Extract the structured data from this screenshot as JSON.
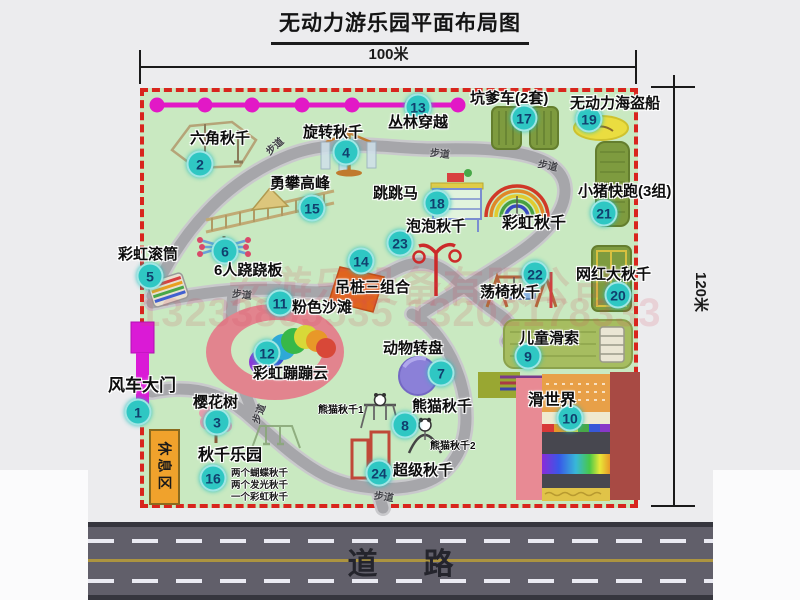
{
  "title": "无动力游乐园平面布局图",
  "dim_top": "100米",
  "dim_right": "120米",
  "road": {
    "label": "道路"
  },
  "rest_area": "休息区",
  "walkway_text": "步道",
  "watermark": {
    "line1": "安游乐设备有限公司",
    "line2": "13233805535 13202178333"
  },
  "colors": {
    "badge_fill": "#2fc7c3",
    "badge_text": "#10406e",
    "border_red": "#d8251d",
    "park_green": "#c9e9c1",
    "path_gray": "#a6a6aa",
    "zipline_magenta": "#e218c6",
    "gate_magenta": "#da1ad6",
    "rest_orange": "#f0a22c",
    "road_gray": "#615f6a",
    "watermark_pink": "rgba(214,72,92,0.38)"
  },
  "attractions": [
    {
      "id": 1,
      "name": "风车大门",
      "bx": 138,
      "by": 412,
      "lx": 108,
      "ly": 377,
      "ls": 17
    },
    {
      "id": 2,
      "name": "六角秋千",
      "bx": 200,
      "by": 164,
      "lx": 190,
      "ly": 131
    },
    {
      "id": 3,
      "name": "樱花树",
      "bx": 217,
      "by": 422,
      "lx": 193,
      "ly": 395
    },
    {
      "id": 4,
      "name": "旋转秋千",
      "bx": 346,
      "by": 152,
      "lx": 303,
      "ly": 125
    },
    {
      "id": 5,
      "name": "彩虹滚筒",
      "bx": 150,
      "by": 276,
      "lx": 118,
      "ly": 247
    },
    {
      "id": 6,
      "name": "6人跷跷板",
      "bx": 225,
      "by": 251,
      "lx": 214,
      "ly": 263
    },
    {
      "id": 7,
      "name": "动物转盘",
      "bx": 441,
      "by": 373,
      "lx": 383,
      "ly": 341
    },
    {
      "id": 8,
      "name": "熊猫秋千",
      "bx": 405,
      "by": 425,
      "lx": 412,
      "ly": 399
    },
    {
      "id": 9,
      "name": "儿童滑索",
      "bx": 528,
      "by": 356,
      "lx": 519,
      "ly": 331
    },
    {
      "id": 10,
      "name": "滑世界",
      "bx": 570,
      "by": 418,
      "lx": 528,
      "ly": 393,
      "ls": 16
    },
    {
      "id": 11,
      "name": "粉色沙滩",
      "bx": 280,
      "by": 303,
      "lx": 292,
      "ly": 300
    },
    {
      "id": 12,
      "name": "彩虹蹦蹦云",
      "bx": 267,
      "by": 353,
      "lx": 253,
      "ly": 366
    },
    {
      "id": 13,
      "name": "丛林穿越",
      "bx": 418,
      "by": 107,
      "lx": 388,
      "ly": 115
    },
    {
      "id": 14,
      "name": "吊桩三组合",
      "bx": 361,
      "by": 261,
      "lx": 335,
      "ly": 280
    },
    {
      "id": 15,
      "name": "勇攀高峰",
      "bx": 312,
      "by": 208,
      "lx": 270,
      "ly": 176
    },
    {
      "id": 16,
      "name": "秋千乐园",
      "bx": 213,
      "by": 478,
      "lx": 198,
      "ly": 448,
      "ls": 16
    },
    {
      "id": 17,
      "name": "坑爹车(2套)",
      "bx": 524,
      "by": 118,
      "lx": 470,
      "ly": 91
    },
    {
      "id": 18,
      "name": "跳跳马",
      "bx": 437,
      "by": 203,
      "lx": 373,
      "ly": 186
    },
    {
      "id": 19,
      "name": "无动力海盗船",
      "bx": 589,
      "by": 119,
      "lx": 570,
      "ly": 96
    },
    {
      "id": 20,
      "name": "网红大秋千",
      "bx": 618,
      "by": 295,
      "lx": 576,
      "ly": 267
    },
    {
      "id": 21,
      "name": "小猪快跑(3组)",
      "bx": 604,
      "by": 213,
      "lx": 578,
      "ly": 184
    },
    {
      "id": 22,
      "name": "荡椅秋千",
      "bx": 535,
      "by": 274,
      "lx": 480,
      "ly": 285
    },
    {
      "id": 23,
      "name": "泡泡秋千",
      "bx": 400,
      "by": 243,
      "lx": 406,
      "ly": 219
    },
    {
      "id": 24,
      "name": "超级秋千",
      "bx": 379,
      "by": 473,
      "lx": 393,
      "ly": 463
    }
  ],
  "annotations": [
    {
      "text": "彩虹秋千",
      "x": 502,
      "y": 216,
      "size": 16
    },
    {
      "text": "熊猫秋千1",
      "x": 318,
      "y": 406,
      "size": 10
    },
    {
      "text": "熊猫秋千2",
      "x": 430,
      "y": 442,
      "size": 10
    }
  ],
  "swing_notes": [
    "两个蝴蝶秋千",
    "两个发光秋千",
    "一个彩虹秋千"
  ],
  "walkways": [
    {
      "x": 264,
      "y": 138,
      "rot": -42
    },
    {
      "x": 430,
      "y": 145,
      "rot": 6
    },
    {
      "x": 538,
      "y": 157,
      "rot": 12
    },
    {
      "x": 232,
      "y": 286,
      "rot": 6
    },
    {
      "x": 248,
      "y": 406,
      "rot": -70
    },
    {
      "x": 374,
      "y": 488,
      "rot": 8
    }
  ]
}
